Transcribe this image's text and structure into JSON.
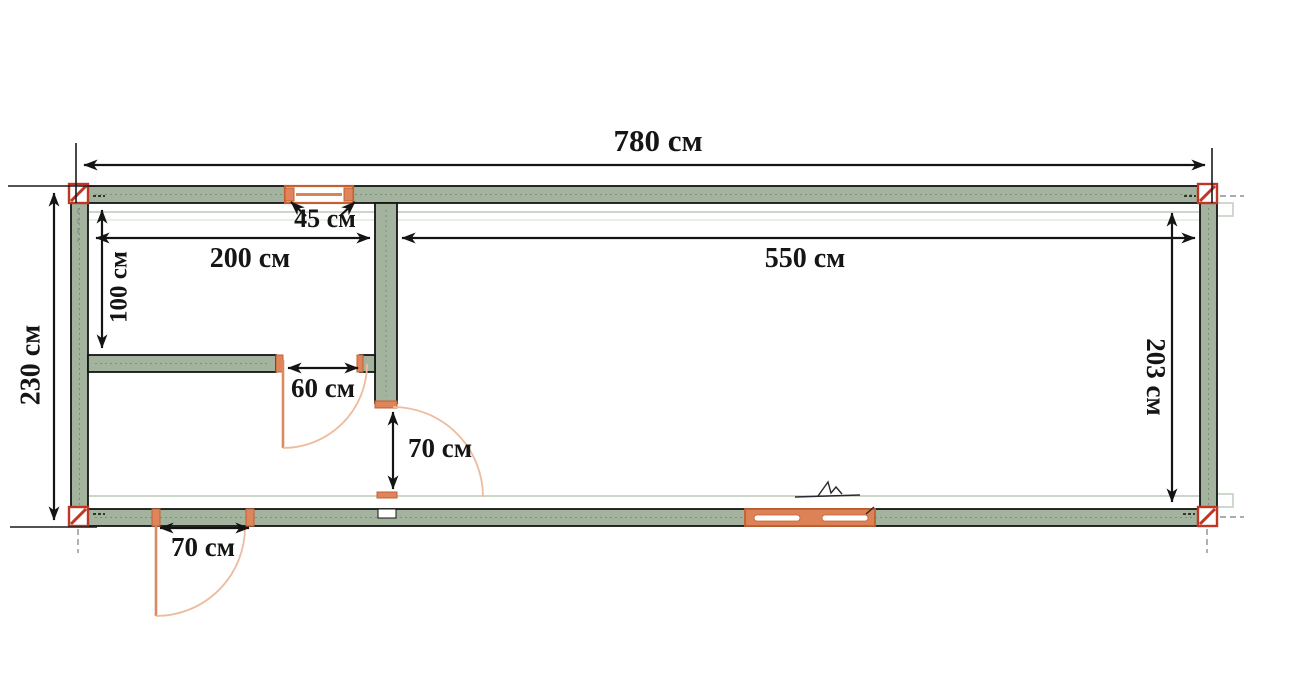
{
  "figure": {
    "type": "floor-plan",
    "unit": "см",
    "labels": {
      "total_width": "780 см",
      "total_depth": "230 см",
      "left_room_width": "200 см",
      "main_room_width": "550 см",
      "left_room_depth": "100 см",
      "inner_depth_right": "203 см",
      "top_window_width": "45 см",
      "inner_door_60": "60 см",
      "inner_door_70": "70 см",
      "entrance_door_70": "70 см"
    },
    "colors": {
      "wall_fill": "#a3b39e",
      "wall_outline": "#141414",
      "corner_post": "#bf3724",
      "door_window": "#dd8157",
      "door_arc": "#edbb9d",
      "inner_face_line": "#bcc9b8"
    }
  }
}
